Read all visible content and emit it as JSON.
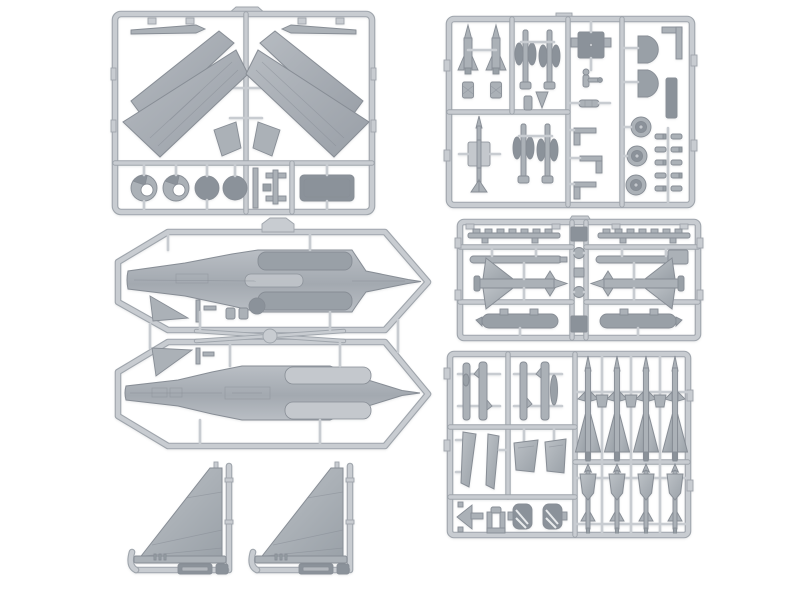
{
  "image": {
    "kind": "product-photo",
    "subject": "Plastic scale model aircraft kit: six light-grey injection-molded sprues (parts trees) laid out on a white background",
    "background": "#ffffff"
  },
  "colors": {
    "bg": "#ffffff",
    "runner": "#c8ccd1",
    "runnerEdge": "#9fa5ac",
    "part": "#abb1b7",
    "partEdge": "#878d95",
    "partDark": "#99a0a7",
    "partDark2": "#8b929a",
    "partLight": "#c4c8cd",
    "wingLight": "#b6bbc1",
    "wingDark": "#999fa7",
    "fusLight": "#b9bec4",
    "fusDark": "#a3a9b0",
    "finLight": "#bcc1c6",
    "finDark": "#9aa1a8"
  },
  "sprues": [
    {
      "id": "sprue-wings",
      "label": "Top-left sprue: four swept wing panels, two slat blades, wheels with hubs, solid discs and a rectangular hatch"
    },
    {
      "id": "sprue-small-parts",
      "label": "Top-right sprue: two finned bombs, slim missile, landing-gear struts, seat box, wheels, intake lips and rows of tiny parts"
    },
    {
      "id": "sprue-fuselage",
      "label": "Middle-left: two octagonal frames holding upper and lower fuselage halves of a twin-engine jet, plus small fins"
    },
    {
      "id": "sprue-stores",
      "label": "Middle-right sprue, mirrored halves: serrated launch rails, missile tubes, large delta-finned missiles and fuel tank pods"
    },
    {
      "id": "sprue-missiles",
      "label": "Bottom-right sprue: four tall delta-finned missiles with four lower missile bodies, missile body halves, wedge fins and small parts"
    },
    {
      "id": "sprue-tailfins",
      "label": "Bottom-left: two vertical tail fins on L-shaped runners with embossed tag plates"
    }
  ]
}
